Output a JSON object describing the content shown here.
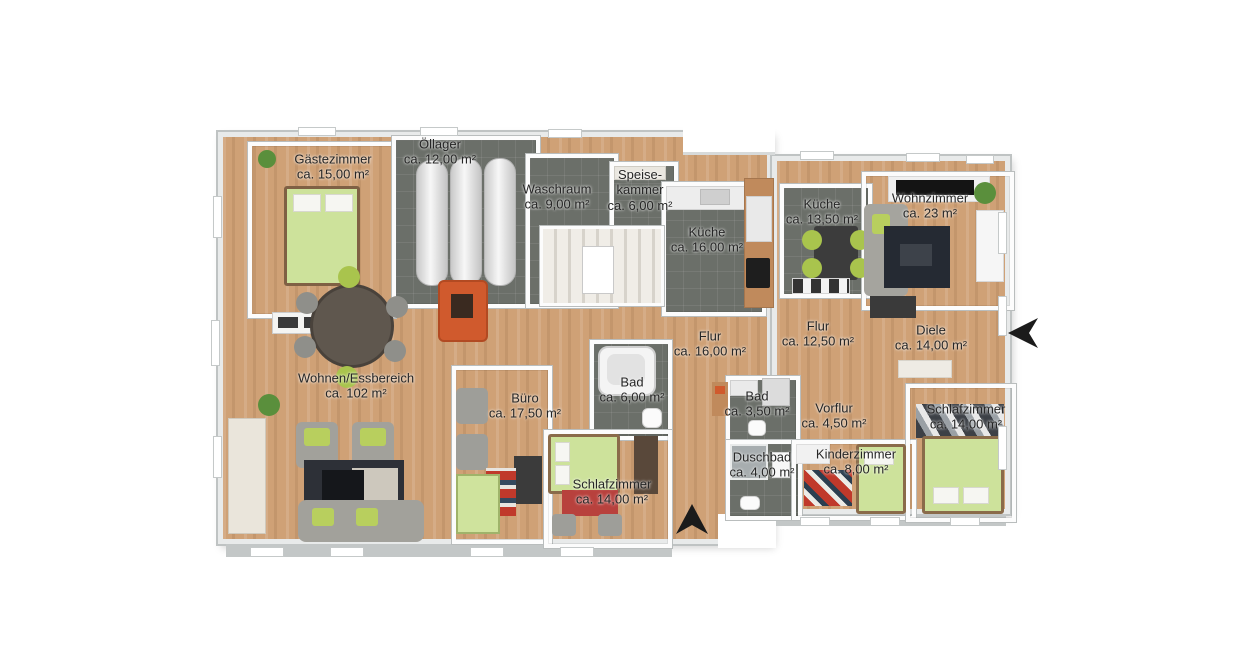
{
  "plan": {
    "type": "3d-floor-plan",
    "rooms": [
      {
        "id": "gaestezimmer",
        "name": "Gästezimmer",
        "area": "ca. 15,00 m²"
      },
      {
        "id": "oellager",
        "name": "Öllager",
        "area": "ca. 12,00 m²"
      },
      {
        "id": "waschraum",
        "name": "Waschraum",
        "area": "ca. 9,00 m²"
      },
      {
        "id": "speisekammer",
        "name": "Speise-kammer",
        "area": "ca. 6,00 m²"
      },
      {
        "id": "kueche-16",
        "name": "Küche",
        "area": "ca. 16,00 m²"
      },
      {
        "id": "kueche-135",
        "name": "Küche",
        "area": "ca. 13,50 m²"
      },
      {
        "id": "wohnzimmer",
        "name": "Wohnzimmer",
        "area": "ca. 23 m²"
      },
      {
        "id": "flur-16",
        "name": "Flur",
        "area": "ca. 16,00 m²"
      },
      {
        "id": "flur-125",
        "name": "Flur",
        "area": "ca. 12,50 m²"
      },
      {
        "id": "diele",
        "name": "Diele",
        "area": "ca. 14,00 m²"
      },
      {
        "id": "wohnen-essbereich",
        "name": "Wohnen/Essbereich",
        "area": "ca. 102 m²"
      },
      {
        "id": "buero",
        "name": "Büro",
        "area": "ca. 17,50 m²"
      },
      {
        "id": "bad-6",
        "name": "Bad",
        "area": "ca. 6,00 m²"
      },
      {
        "id": "schlafzimmer-mitte",
        "name": "Schlafzimmer",
        "area": "ca. 14,00 m²"
      },
      {
        "id": "bad-35",
        "name": "Bad",
        "area": "ca. 3,50 m²"
      },
      {
        "id": "vorflur",
        "name": "Vorflur",
        "area": "ca. 4,50 m²"
      },
      {
        "id": "duschbad",
        "name": "Duschbad",
        "area": "ca. 4,00 m²"
      },
      {
        "id": "kinderzimmer",
        "name": "Kinderzimmer",
        "area": "ca. 8,00 m²"
      },
      {
        "id": "schlafzimmer-rechts",
        "name": "Schlafzimmer",
        "area": "ca. 14,00 m²"
      }
    ],
    "colors": {
      "wood_floor": "#cfa176",
      "tile_floor": "#6b6f69",
      "wall": "#ffffff",
      "wall_outline": "#b9bdbd",
      "exterior_band": "#c3c7c7",
      "label_text": "#262626",
      "furniture_green": "#cde29b",
      "accent_orange": "#d05a2d",
      "arrow_black": "#1b1b1b"
    }
  }
}
